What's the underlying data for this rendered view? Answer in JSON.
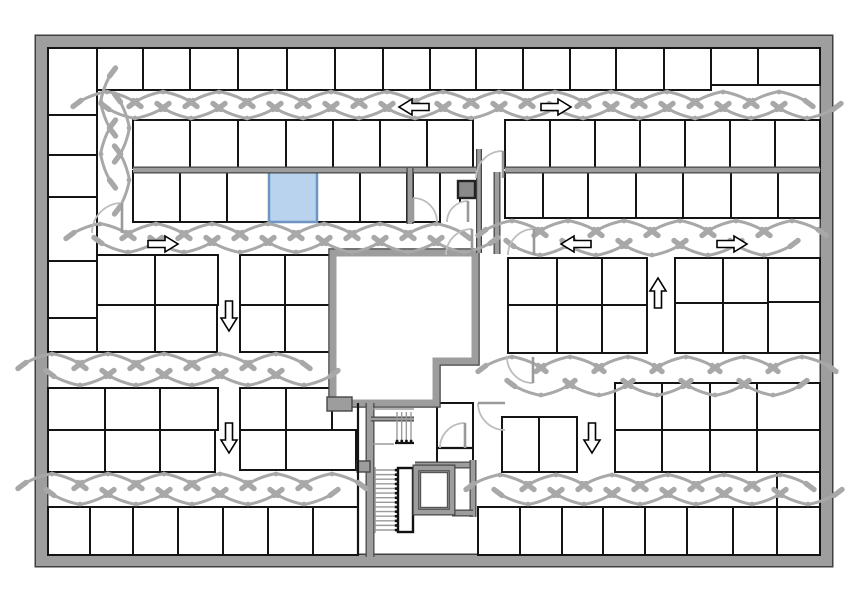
{
  "figure": {
    "kind": "floor-plan",
    "width": 864,
    "height": 598
  },
  "palette": {
    "bg": "#ffffff",
    "outer_wall_fill": "#9e9e9e",
    "outer_wall_edge": "#3f3f3f",
    "room_stroke": "#141414",
    "gray_wall_fill": "#9d9d9d",
    "gray_wall_edge": "#474747",
    "swing": "#a8a8a8",
    "door_arc": "#bdbdbd",
    "door_leaf": "#9a9a9a",
    "arrow_fill": "#ffffff",
    "arrow_stroke": "#000000",
    "highlight_fill": "#b9d3ee",
    "highlight_edge": "#6d94c3",
    "stair_tread": "#9a9a9a",
    "dark_box_fill": "#8a8a8a",
    "dark_box_edge": "#222222"
  },
  "outer_wall": {
    "x": 41.5,
    "y": 41.5,
    "w": 785,
    "h": 519,
    "t": 12
  },
  "highlight_room": {
    "x": 269,
    "y": 171,
    "w": 48,
    "h": 51
  },
  "rooms": [
    [
      48,
      48,
      49,
      67
    ],
    [
      97,
      48,
      46,
      42
    ],
    [
      143,
      48,
      47,
      42
    ],
    [
      190,
      48,
      48,
      42
    ],
    [
      238,
      48,
      49,
      42
    ],
    [
      287,
      48,
      48,
      42
    ],
    [
      335,
      48,
      48,
      42
    ],
    [
      383,
      48,
      47,
      42
    ],
    [
      430,
      48,
      46,
      42
    ],
    [
      476,
      48,
      47,
      42
    ],
    [
      523,
      48,
      47,
      42
    ],
    [
      570,
      48,
      46,
      42
    ],
    [
      616,
      48,
      48,
      42
    ],
    [
      664,
      48,
      47,
      42
    ],
    [
      711,
      48,
      47,
      37
    ],
    [
      758,
      48,
      62,
      37
    ],
    [
      48,
      115,
      49,
      40
    ],
    [
      48,
      155,
      49,
      42
    ],
    [
      48,
      197,
      49,
      64
    ],
    [
      48,
      261,
      49,
      57
    ],
    [
      48,
      318,
      49,
      34
    ],
    [
      133,
      120,
      57,
      48
    ],
    [
      190,
      120,
      48,
      48
    ],
    [
      238,
      120,
      48,
      48
    ],
    [
      286,
      120,
      47,
      48
    ],
    [
      333,
      120,
      47,
      48
    ],
    [
      380,
      120,
      47,
      48
    ],
    [
      427,
      120,
      46,
      48
    ],
    [
      505,
      120,
      45,
      48
    ],
    [
      550,
      120,
      45,
      48
    ],
    [
      595,
      120,
      45,
      48
    ],
    [
      640,
      120,
      45,
      48
    ],
    [
      685,
      120,
      45,
      48
    ],
    [
      730,
      120,
      45,
      48
    ],
    [
      775,
      120,
      45,
      48
    ],
    [
      133,
      171,
      47,
      51
    ],
    [
      180,
      171,
      47,
      51
    ],
    [
      227,
      171,
      42,
      51
    ],
    [
      317,
      171,
      43,
      51
    ],
    [
      360,
      171,
      47,
      51
    ],
    [
      413,
      171,
      27,
      51
    ],
    [
      505,
      172,
      38,
      46
    ],
    [
      543,
      172,
      45,
      46
    ],
    [
      588,
      172,
      48,
      46
    ],
    [
      636,
      172,
      47,
      46
    ],
    [
      683,
      172,
      48,
      46
    ],
    [
      731,
      172,
      47,
      46
    ],
    [
      778,
      172,
      42,
      46
    ],
    [
      97,
      255,
      58,
      50
    ],
    [
      155,
      255,
      63,
      50
    ],
    [
      97,
      305,
      58,
      47
    ],
    [
      155,
      305,
      62,
      47
    ],
    [
      240,
      255,
      45,
      50
    ],
    [
      285,
      255,
      45,
      50
    ],
    [
      240,
      305,
      45,
      47
    ],
    [
      285,
      305,
      45,
      47
    ],
    [
      508,
      258,
      49,
      47
    ],
    [
      557,
      258,
      45,
      47
    ],
    [
      602,
      258,
      45,
      47
    ],
    [
      508,
      305,
      49,
      48
    ],
    [
      557,
      305,
      45,
      48
    ],
    [
      602,
      305,
      45,
      48
    ],
    [
      675,
      258,
      48,
      45
    ],
    [
      723,
      258,
      45,
      45
    ],
    [
      675,
      303,
      48,
      50
    ],
    [
      723,
      303,
      45,
      50
    ],
    [
      768,
      258,
      52,
      44
    ],
    [
      768,
      302,
      52,
      51
    ],
    [
      48,
      388,
      57,
      42
    ],
    [
      105,
      388,
      55,
      42
    ],
    [
      160,
      388,
      58,
      42
    ],
    [
      48,
      430,
      57,
      42
    ],
    [
      105,
      430,
      55,
      42
    ],
    [
      160,
      430,
      55,
      42
    ],
    [
      240,
      388,
      46,
      42
    ],
    [
      286,
      388,
      46,
      42
    ],
    [
      240,
      430,
      46,
      40
    ],
    [
      286,
      430,
      70,
      40
    ],
    [
      502,
      417,
      37,
      55
    ],
    [
      539,
      417,
      38,
      55
    ],
    [
      615,
      383,
      47,
      47
    ],
    [
      662,
      383,
      48,
      47
    ],
    [
      615,
      430,
      47,
      42
    ],
    [
      662,
      430,
      48,
      42
    ],
    [
      710,
      383,
      47,
      47
    ],
    [
      757,
      383,
      63,
      47
    ],
    [
      710,
      430,
      47,
      42
    ],
    [
      757,
      430,
      63,
      42
    ],
    [
      48,
      507,
      42,
      48
    ],
    [
      90,
      507,
      43,
      48
    ],
    [
      133,
      507,
      45,
      48
    ],
    [
      178,
      507,
      45,
      48
    ],
    [
      223,
      507,
      45,
      48
    ],
    [
      268,
      507,
      45,
      48
    ],
    [
      313,
      507,
      45,
      48
    ],
    [
      478,
      507,
      42,
      48
    ],
    [
      520,
      507,
      42,
      48
    ],
    [
      562,
      507,
      41,
      48
    ],
    [
      603,
      507,
      42,
      48
    ],
    [
      645,
      507,
      42,
      48
    ],
    [
      687,
      507,
      46,
      48
    ],
    [
      733,
      507,
      44,
      48
    ],
    [
      777,
      507,
      43,
      48
    ],
    [
      777,
      472,
      43,
      35
    ],
    [
      437,
      403,
      36,
      62
    ]
  ],
  "core": {
    "points": "333,253 475,253 475,361 436,361 436,403 333,403",
    "t": 7
  },
  "gray_walls": [
    [
      133,
      170,
      477,
      170,
      5
    ],
    [
      505,
      170,
      820,
      170,
      5
    ],
    [
      410,
      168,
      410,
      224,
      5
    ],
    [
      497,
      172,
      497,
      254,
      5
    ],
    [
      479,
      149,
      479,
      253,
      4
    ],
    [
      370,
      403,
      370,
      557,
      7
    ],
    [
      415,
      465,
      473,
      465,
      5
    ],
    [
      473,
      460,
      473,
      517,
      5
    ],
    [
      452,
      513,
      473,
      513,
      5
    ],
    [
      371,
      419,
      414,
      419,
      3
    ]
  ],
  "gray_blocks": [
    [
      327,
      397,
      25,
      14
    ],
    [
      357,
      461,
      13,
      11
    ]
  ],
  "black_lines": [
    [
      437,
      448,
      473,
      448
    ],
    [
      358,
      403,
      358,
      555
    ],
    [
      395,
      443,
      414,
      443
    ]
  ],
  "gray_thin_lines": [
    [
      371,
      409,
      414,
      409
    ],
    [
      371,
      444,
      394,
      444
    ]
  ],
  "dark_box": {
    "x": 458,
    "y": 181,
    "w": 17,
    "h": 17
  },
  "elevator": {
    "x": 416,
    "y": 468,
    "w": 36,
    "h": 44
  },
  "stair_side_box": {
    "x": 398,
    "y": 468,
    "w": 15,
    "h": 64
  },
  "stairs_lower": {
    "x0": 375,
    "x1": 396,
    "y0": 470,
    "y1": 530,
    "n": 14
  },
  "stairs_upper": {
    "y0": 412,
    "y1": 441,
    "x0": 397,
    "x1": 411,
    "n": 4
  },
  "swing_corridors": [
    {
      "dir": "h",
      "x0": 107,
      "x1": 812,
      "yt": 91,
      "yb": 119,
      "step": 56
    },
    {
      "dir": "h",
      "x0": 100,
      "x1": 466,
      "yt": 223,
      "yb": 253,
      "step": 56
    },
    {
      "dir": "h",
      "x0": 512,
      "x1": 812,
      "yt": 220,
      "yb": 256,
      "step": 56
    },
    {
      "dir": "h",
      "x0": 52,
      "x1": 330,
      "yt": 353,
      "yb": 386,
      "step": 56
    },
    {
      "dir": "h",
      "x0": 512,
      "x1": 812,
      "yt": 356,
      "yb": 396,
      "step": 58
    },
    {
      "dir": "h",
      "x0": 52,
      "x1": 352,
      "yt": 473,
      "yb": 505,
      "step": 56
    },
    {
      "dir": "h",
      "x0": 500,
      "x1": 812,
      "yt": 474,
      "yb": 505,
      "step": 56
    }
  ],
  "swing_vcorridors": [
    {
      "xl": 100,
      "xr": 130,
      "y0": 102,
      "y1": 205,
      "step": 52
    }
  ],
  "doors": [
    {
      "arc": "M122,203 A30,30 0 0 0 92,233",
      "leaf": [
        122,
        233,
        122,
        203
      ]
    },
    {
      "arc": "M503,151 A27,27 0 0 0 476,178",
      "leaf": [
        503,
        178,
        503,
        151
      ]
    },
    {
      "arc": "M413,198 A24,24 0 0 1 437,222",
      "leaf": [
        413,
        222,
        413,
        198
      ]
    },
    {
      "arc": "M468,201 A21,21 0 0 0 447,222",
      "leaf": [
        468,
        222,
        468,
        201
      ]
    },
    {
      "arc": "M472,229 A26,26 0 0 0 446,255",
      "leaf": [
        472,
        255,
        472,
        229
      ]
    },
    {
      "arc": "M534,229 A26,26 0 0 0 508,255",
      "leaf": [
        534,
        255,
        534,
        229
      ]
    },
    {
      "arc": "M533,383 A26,26 0 0 1 507,357",
      "leaf": [
        533,
        357,
        533,
        383
      ]
    },
    {
      "arc": "M478,403 A27,27 0 0 0 505,430",
      "leaf": [
        505,
        403,
        478,
        403
      ]
    },
    {
      "arc": "M465,423 A25,25 0 0 0 440,448",
      "leaf": [
        465,
        448,
        465,
        423
      ]
    }
  ],
  "arrows": [
    {
      "x": 414,
      "y": 107,
      "dir": "left"
    },
    {
      "x": 556,
      "y": 107,
      "dir": "right"
    },
    {
      "x": 163,
      "y": 244,
      "dir": "right"
    },
    {
      "x": 576,
      "y": 244,
      "dir": "left"
    },
    {
      "x": 732,
      "y": 244,
      "dir": "right"
    },
    {
      "x": 229,
      "y": 316,
      "dir": "down"
    },
    {
      "x": 658,
      "y": 293,
      "dir": "up"
    },
    {
      "x": 229,
      "y": 438,
      "dir": "down"
    },
    {
      "x": 592,
      "y": 438,
      "dir": "down"
    }
  ]
}
